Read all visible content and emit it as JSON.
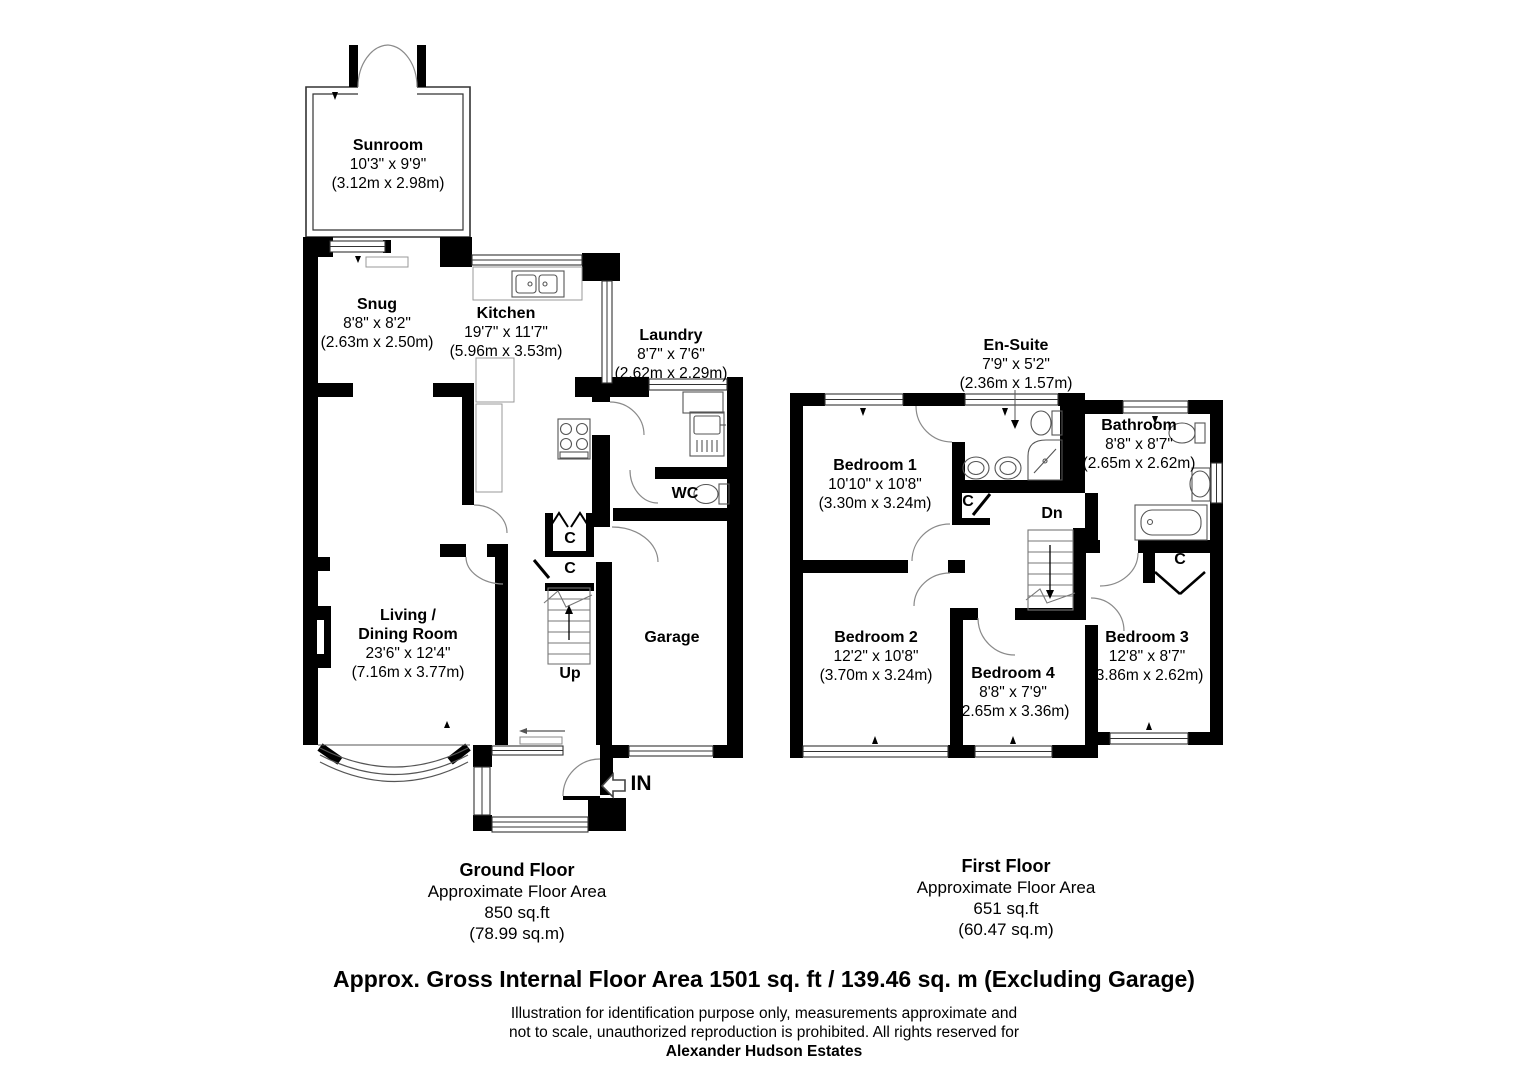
{
  "ground_floor": {
    "rooms": [
      {
        "id": "sunroom",
        "name": "Sunroom",
        "dims_imperial": "10'3\" x 9'9\"",
        "dims_metric": "(3.12m x 2.98m)"
      },
      {
        "id": "snug",
        "name": "Snug",
        "dims_imperial": "8'8\" x 8'2\"",
        "dims_metric": "(2.63m x 2.50m)"
      },
      {
        "id": "kitchen",
        "name": "Kitchen",
        "dims_imperial": "19'7\" x 11'7\"",
        "dims_metric": "(5.96m x 3.53m)"
      },
      {
        "id": "laundry",
        "name": "Laundry",
        "dims_imperial": "8'7\" x 7'6\"",
        "dims_metric": "(2.62m x 2.29m)"
      },
      {
        "id": "wc",
        "name": "WC"
      },
      {
        "id": "living",
        "name_line1": "Living /",
        "name_line2": "Dining Room",
        "dims_imperial": "23'6\" x 12'4\"",
        "dims_metric": "(7.16m x 3.77m)"
      },
      {
        "id": "garage",
        "name": "Garage"
      }
    ],
    "labels": {
      "up": "Up",
      "closet": "C",
      "entrance": "IN"
    },
    "summary": {
      "title": "Ground Floor",
      "subtitle": "Approximate Floor Area",
      "area_ft": "850 sq.ft",
      "area_m": "(78.99 sq.m)"
    }
  },
  "first_floor": {
    "rooms": [
      {
        "id": "bedroom1",
        "name": "Bedroom 1",
        "dims_imperial": "10'10\" x 10'8\"",
        "dims_metric": "(3.30m x 3.24m)"
      },
      {
        "id": "ensuite",
        "name": "En-Suite",
        "dims_imperial": "7'9\" x 5'2\"",
        "dims_metric": "(2.36m x 1.57m)"
      },
      {
        "id": "bathroom",
        "name": "Bathroom",
        "dims_imperial": "8'8\" x 8'7\"",
        "dims_metric": "(2.65m x 2.62m)"
      },
      {
        "id": "bedroom2",
        "name": "Bedroom 2",
        "dims_imperial": "12'2\" x 10'8\"",
        "dims_metric": "(3.70m x 3.24m)"
      },
      {
        "id": "bedroom4",
        "name": "Bedroom 4",
        "dims_imperial": "8'8\" x 7'9\"",
        "dims_metric": "(2.65m x 3.36m)"
      },
      {
        "id": "bedroom3",
        "name": "Bedroom 3",
        "dims_imperial": "12'8\" x 8'7\"",
        "dims_metric": "(3.86m x 2.62m)"
      }
    ],
    "labels": {
      "dn": "Dn",
      "closet": "C"
    },
    "summary": {
      "title": "First Floor",
      "subtitle": "Approximate Floor Area",
      "area_ft": "651 sq.ft",
      "area_m": "(60.47 sq.m)"
    }
  },
  "footer": {
    "total_area": "Approx. Gross Internal Floor Area 1501 sq. ft / 139.46 sq. m (Excluding Garage)",
    "disclaimer_line1": "Illustration for identification purpose only, measurements approximate and",
    "disclaimer_line2": "not to scale, unauthorized reproduction is prohibited. All rights reserved for",
    "company": "Alexander Hudson Estates"
  },
  "colors": {
    "wall": "#000000",
    "thin_line": "#555555",
    "arc_line": "#8a8a8a",
    "background": "#ffffff"
  }
}
